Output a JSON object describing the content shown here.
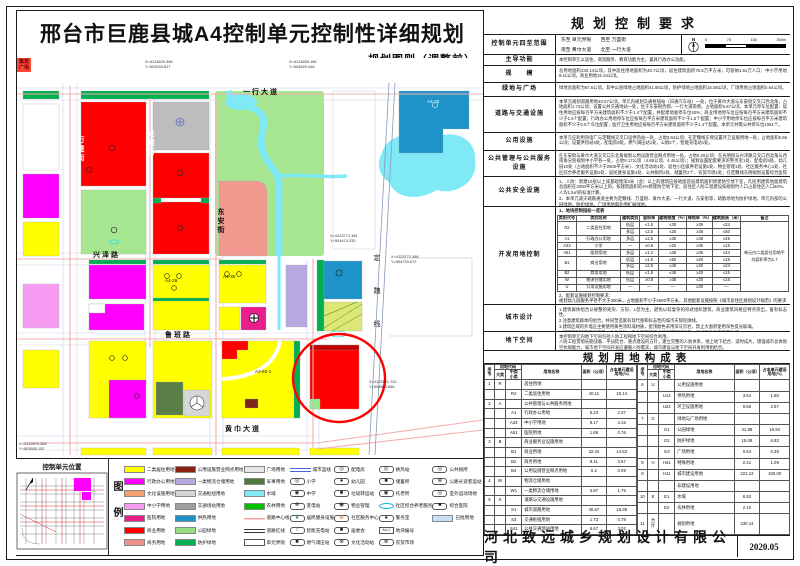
{
  "title": {
    "main": "邢台市巨鹿县城A4控制单元控制性详细规划",
    "sub": "——规划图则（调整前）"
  },
  "map": {
    "labels": [
      {
        "t": "一行大道",
        "x": 226,
        "y": 31,
        "cls": "s"
      },
      {
        "t": "兴泽路",
        "x": 76,
        "y": 194,
        "cls": "s"
      },
      {
        "t": "鲁班路",
        "x": 148,
        "y": 274,
        "cls": "s"
      },
      {
        "t": "黄巾大道",
        "x": 208,
        "y": 368,
        "cls": "s"
      },
      {
        "t": "万盛街",
        "x": 60,
        "y": 78,
        "cls": "v w"
      },
      {
        "t": "光明街",
        "x": 130,
        "y": 72,
        "cls": "v w"
      },
      {
        "t": "东安街",
        "x": 200,
        "y": 150,
        "cls": "v"
      },
      {
        "t": "定魏线",
        "x": 356,
        "y": 196,
        "cls": "v sp"
      },
      {
        "t": "A4-70",
        "x": 410,
        "y": 42,
        "cls": "b w"
      },
      {
        "t": "A4-26",
        "x": 148,
        "y": 221,
        "cls": "b"
      },
      {
        "t": "A4-30",
        "x": 206,
        "y": 217,
        "cls": "b"
      },
      {
        "t": "A4-62-1",
        "x": 238,
        "y": 312,
        "cls": "b"
      }
    ],
    "coords": [
      {
        "l1": "X=4124629.306",
        "l2": "Y=503253.817",
        "x": 128,
        "y": 2
      },
      {
        "l1": "X=4124655.185",
        "l2": "Y=504629.448",
        "x": 272,
        "y": 2
      },
      {
        "l1": "X=4123771.381",
        "l2": "Y=504474.333",
        "x": 313,
        "y": 176
      },
      {
        "l1": "X=4123771.388",
        "l2": "Y=504733.672",
        "x": 374,
        "y": 197
      },
      {
        "l1": "X=4122991.722",
        "l2": "Y=504603.668",
        "x": 352,
        "y": 322
      },
      {
        "l1": "X=4122876.355",
        "l2": "Y=503555.152",
        "x": 2,
        "y": 384
      }
    ],
    "plaza": {
      "l1": "集贸",
      "l2": "广场",
      "x": 86,
      "y": 284
    }
  },
  "unit_location": {
    "title": "控制单元位置"
  },
  "legend": {
    "label": "图例",
    "columns": [
      [
        {
          "label": "二类居住用地",
          "sw": "c",
          "c": "#FFFF00"
        },
        {
          "label": "行政办公用地",
          "sw": "c",
          "c": "#FF00FF"
        },
        {
          "label": "文化设施用地",
          "sw": "c",
          "c": "#F4A070"
        },
        {
          "label": "中小学用地",
          "sw": "c",
          "c": "#F79CF2"
        },
        {
          "label": "医院用地",
          "sw": "c",
          "c": "#E91E8C"
        },
        {
          "label": "商业用地",
          "sw": "c",
          "c": "#FF0000"
        },
        {
          "label": "商务用地",
          "sw": "c",
          "c": "#F0908A"
        }
      ],
      [
        {
          "label": "公用设施营业网点用地",
          "sw": "c",
          "c": "#8B2015"
        },
        {
          "label": "一类物流仓储用地",
          "sw": "c",
          "c": "#B8A8E0"
        },
        {
          "label": "交通枢纽用地",
          "sw": "c",
          "c": "#D6D6D6"
        },
        {
          "label": "交通场站用地",
          "sw": "c",
          "c": "#9E9E9E"
        },
        {
          "label": "供热用地",
          "sw": "c",
          "c": "#1E93C8"
        },
        {
          "label": "公园绿地",
          "sw": "c",
          "c": "#97E081"
        },
        {
          "label": "防护绿地",
          "sw": "c",
          "c": "#00B050"
        }
      ],
      [
        {
          "label": "广场用地",
          "sw": "c",
          "c": "#E8E8E8"
        },
        {
          "label": "军事用地",
          "sw": "c",
          "c": "#4C7A3D"
        },
        {
          "label": "水域",
          "sw": "c",
          "c": "#7FE9F5"
        },
        {
          "label": "农林用地",
          "sw": "c",
          "c": "#00C000"
        },
        {
          "label": "道路中心线",
          "sw": "ln"
        },
        {
          "label": "道路红线",
          "sw": "ld"
        },
        {
          "label": "单元界限",
          "sw": "box"
        }
      ],
      [
        {
          "label": "城市蓝线",
          "sw": "lb"
        },
        {
          "label": "小学",
          "sw": "i",
          "g": "◎"
        },
        {
          "label": "中学",
          "sw": "i",
          "g": "◉"
        },
        {
          "label": "变电站",
          "sw": "i",
          "g": "⊗"
        },
        {
          "label": "居民健身设施",
          "sw": "i",
          "g": "●",
          "gc": "#2e9e3e"
        },
        {
          "label": "智能充电站",
          "sw": "i",
          "g": "○",
          "gc": "#3355cc"
        },
        {
          "label": "燃气调压站",
          "sw": "i",
          "g": "■"
        }
      ],
      [
        {
          "label": "配电房",
          "sw": "i",
          "g": "◎"
        },
        {
          "label": "幼儿园",
          "sw": "i",
          "g": "●"
        },
        {
          "label": "垃圾转运站",
          "sw": "i",
          "g": "■"
        },
        {
          "label": "物业管理",
          "sw": "i",
          "g": "◉"
        },
        {
          "label": "社区服务中心",
          "sw": "i",
          "g": "⊕",
          "gc": "#e07820"
        },
        {
          "label": "居委会",
          "sw": "i",
          "g": "■"
        },
        {
          "label": "文化活动站",
          "sw": "i",
          "g": "⊗"
        }
      ],
      [
        {
          "label": "换热站",
          "sw": "i",
          "g": "◎"
        },
        {
          "label": "储蓄所",
          "sw": "i",
          "g": "■"
        },
        {
          "label": "托老所",
          "sw": "i",
          "g": "◉"
        },
        {
          "label": "社区综合养老服务",
          "sw": "ov"
        },
        {
          "label": "警务室",
          "sw": "i",
          "g": "●"
        },
        {
          "label": "地块编号",
          "sw": "code",
          "g": "A4-1"
        },
        {
          "label": "农贸市场",
          "sw": "i",
          "g": "⊗"
        }
      ],
      [
        {
          "label": "公共厕所",
          "sw": "i",
          "g": "◎"
        },
        {
          "label": "公路长途客运站",
          "sw": "i",
          "g": "⊗"
        },
        {
          "label": "室外运动场地",
          "sw": "i",
          "g": "◎"
        },
        {
          "label": "综合医院",
          "sw": "i",
          "g": "■"
        },
        {
          "label": "已批用地",
          "sw": "c",
          "c": "#C9DFF5"
        }
      ]
    ]
  },
  "panel": {
    "title": "规划控制要求",
    "extent": {
      "label": "控制单元四至范围",
      "line1": "东至 单元界限　　西至 万盛街",
      "line2": "南至 黄巾大道　　北至 一行大道"
    },
    "compass": "N",
    "scalebar": {
      "t0": "0",
      "t1": "75",
      "t2": "150",
      "t3": "300m"
    },
    "rows": [
      {
        "label": "主导功能",
        "h": 11,
        "text": "本控制单元以居住、商贸服务、教育功能为主，兼具行政办公功能。"
      },
      {
        "label": "规　　模",
        "h": 17,
        "text": "总用地面积230.14公顷，其中居住用地面积为40.7公顷，居住建筑面积76.5万平方米，可容纳1.51万人口；中小学用地9.11公顷，商业用地32.34公顷。"
      },
      {
        "label": "绿地与广场",
        "h": 14,
        "text": "绿地总面积为67.6公顷，其中公园绿地占地面积41.88公顷，防护绿地占地面积15.08公顷，广场用地占地面积0.64公顷。"
      },
      {
        "label": "道路与交通设施",
        "h": 36,
        "text": "本单元规划道路用地40.67公顷。单元内规划交通枢纽站（日通汽车站）一处，位于黄巾大道与东安街交叉口西北角，占地面积1.73公顷；设置公共交通场站一处，位于东安街西侧、一行大道南侧，占地面积6.67公顷。本单元停车位配置：居住用地应按每百平方米建筑面积不少于1.4个配置，并配建地面停车位40%；商业用地停车位应按每百平方米建筑面积不少于1.5个配置；行政办公用地停车位应按每百平方米建筑面积不少于1.5个配置；中小学用地停车位应按每百平方米建筑面积不少于0.5个车位配置；医疗卫生用地应按每百平方米建筑面积不少于1.4个配置。本单元共需公共停车位1051个。"
      },
      {
        "label": "公用设施",
        "h": 18,
        "text": "本单元应利用热电厂与定魏线交叉口设供热站一处，占地3.94公顷；在定魏线东侧设置环卫设施用地一处，占地面积6.56公顷；设置供热站4处，配电房9处，燃气调压站1处，公厕2个，智能充电站1处。"
      },
      {
        "label": "公共管理与公共服务设施",
        "h": 26,
        "text": "在东安街与黄巾大道交叉口东北角规划公用设施营业网点用地一处，占地0.20公顷；在光明街与兴泽路交叉口西北角与西南角分别规划中小学各一处，占地9.17公顷（4.89公顷、4.46公顷）；规划设置配套要求的警务室1处、配电房9处、幼儿园10处（占地面积不少于2600平方米）、文化活动站1处、居住小区级养老设施1处、物业管理1处、社区服务中心1处、社区综合养老服务设施2处、居民健身设施4处、公共厕所2处、储蓄所2个、农贸市场1处；在定魏线东侧规划设置综合医院1个，占地面积2.35公顷。"
      },
      {
        "label": "公共安全设施",
        "h": 30,
        "text": "1、人防：新建10层以上或基础埋深3米（含）以上的建筑应按地面首层建筑面积修建防空地下室，凡民用建筑地面建筑总面积在2000平方米以上的，按建筑面积的2%修建防空地下室；居住区人防工程建设按规划时人口占居住区人口60%、人均1.5㎡的标准计算。\n2、本单元减灾疏散通道主要为定魏线、万盛街、黄巾大道、一行大道、东安街等，疏散场地为防护绿地、单元内部的公园绿地、防护绿地、广场用地和外围扩展绿地。"
      }
    ],
    "dev": {
      "label": "开发用地控制",
      "note1": "1、地块控制指标一览表",
      "table": {
        "head": [
          [
            "类别代号",
            "类别名称",
            "建筑类别",
            "容积率",
            "建筑密度（%）",
            "绿地率（%）",
            "建筑限高（米）",
            "备注"
          ]
        ],
        "body": [
          [
            {
              "t": "R2",
              "rs": 2
            },
            {
              "t": "二类居住用地",
              "rs": 2
            },
            "低层",
            "≤1.5",
            "≤30",
            "≥35",
            "≤24",
            {
              "t": "单元内二类居住用地平均容积率为1.7",
              "rs": 10,
              "cls": "beizhu"
            }
          ],
          [
            "多层",
            "≤2.5",
            "≤25",
            "≥35",
            "≤60"
          ],
          [
            "A1",
            "行政办公用地",
            "多层",
            "≤2.5",
            "≤35",
            "≥35",
            "≤45"
          ],
          [
            "A33",
            "小学",
            "—",
            "≤0.8",
            "≤25",
            "≥35",
            "≤15"
          ],
          [
            "A51",
            "医院用地",
            "多层",
            "≤1.2",
            "≤35",
            "≥35",
            "≤24"
          ],
          [
            {
              "t": "B1",
              "rs": 2
            },
            {
              "t": "商业用地",
              "rs": 2
            },
            "低层",
            "≤1.5",
            "≤50",
            "≥20",
            "≤15"
          ],
          [
            "多层",
            "≤2.5",
            "≤45",
            "≥20",
            "≤24"
          ],
          [
            "B2",
            "商务用地",
            "低层",
            "≤1.5",
            "≤45",
            "≥20",
            "≤15"
          ],
          [
            "W",
            "物流仓储用地",
            "低层",
            "≥0.8",
            "≥35",
            "≤20",
            "≤16"
          ],
          [
            "U",
            "公用设施用地",
            "—",
            "—",
            "—",
            "≥30",
            "—"
          ]
        ]
      },
      "note2": "2、配套设施规划控制要求：\n规划幼儿园服务半径不大于300米，占地面积不小于2600平方米，其他配套设施按照《城市居住区规划设计规范》的要求配置。"
    },
    "urban": {
      "label": "城市设计",
      "text": "1.建筑群体组合以规整的矩形、方形、L型为主，避免以较复杂的形式组织建筑，商业建筑风格应特点突出，富有标志性。\n2.注意建筑群体的组合，共同塑造富有现代感和标志性的城市天际轮廓线。\n3.建筑区域的外墙应主要使用黄色涂料或材质，屋顶颜色采用深灰页岩，禁止大面积使用深色反光玻璃。\n4.建筑照明设施要与建筑一体化设计，商业建筑顶部必须有照明灯设施，且光源色彩应表现协调。"
    },
    "under": {
      "label": "地下空间",
      "text": "本控制单元内地下空间包括人防工程和地下空间综合利用。\n人防工程贯彻长期战备、平战结合、重点建设的方针，建立完整的人防体系，地上地下结合、适时成片，增强城市总体防空抗毁能力，城市地下空间开发应遵循人防需求，城市建设与地下空间开发利用相结合。"
    }
  },
  "land_table": {
    "title": "规划用地构成表",
    "left": {
      "head": [
        [
          {
            "t": "序号",
            "rs": 2
          },
          {
            "t": "用地代码",
            "cs": 2
          },
          {
            "t": "用地名称",
            "rs": 2
          },
          {
            "t": "面积（公顷）",
            "rs": 2
          },
          {
            "t": "占本单元建设用地(%)",
            "rs": 2
          }
        ],
        [
          "大类",
          "中类 小类"
        ]
      ],
      "body": [
        [
          "1",
          "R",
          "",
          {
            "t": "居住用地",
            "cls": "nm"
          },
          "",
          ""
        ],
        [
          "",
          "",
          "R2",
          {
            "t": "二类居住用地",
            "cls": "nm"
          },
          "40.11",
          "18.14"
        ],
        [
          "2",
          "A",
          "",
          {
            "t": "公共管理与公共服务用地",
            "cls": "nm"
          },
          "",
          ""
        ],
        [
          "",
          "",
          "A1",
          {
            "t": "行政办公用地",
            "cls": "nm"
          },
          "5.23",
          "2.37"
        ],
        [
          "",
          "",
          "A33",
          {
            "t": "中小学用地",
            "cls": "nm"
          },
          "9.17",
          "4.15"
        ],
        [
          "",
          "",
          "A51",
          {
            "t": "医院用地",
            "cls": "nm"
          },
          "1.69",
          "0.76"
        ],
        [
          "3",
          "B",
          "",
          {
            "t": "商业服务业设施用地",
            "cls": "nm"
          },
          "",
          ""
        ],
        [
          "",
          "",
          "B1",
          {
            "t": "商业用地",
            "cls": "nm"
          },
          "32.34",
          "14.63"
        ],
        [
          "",
          "",
          "B2",
          {
            "t": "商务用地",
            "cls": "nm"
          },
          "8.11",
          "3.67"
        ],
        [
          "",
          "",
          "B4",
          {
            "t": "公用设施营业网点用地",
            "cls": "nm"
          },
          "0.2",
          "0.09"
        ],
        [
          "4",
          "W",
          "",
          {
            "t": "物流仓储用地",
            "cls": "nm"
          },
          "",
          ""
        ],
        [
          "",
          "",
          "W1",
          {
            "t": "一类物流仓储用地",
            "cls": "nm"
          },
          "3.87",
          "1.75"
        ],
        [
          "5",
          "S",
          "",
          {
            "t": "道路与交通设施用地",
            "cls": "nm"
          },
          "",
          ""
        ],
        [
          "",
          "",
          "S1",
          {
            "t": "城市道路用地",
            "cls": "nm"
          },
          "40.67",
          "18.39"
        ],
        [
          "",
          "",
          "S3",
          {
            "t": "交通枢纽用地",
            "cls": "nm"
          },
          "1.73",
          "0.78"
        ],
        [
          "",
          "",
          "S41",
          {
            "t": "公共交通场站用地",
            "cls": "nm"
          },
          "6.67",
          "3.02"
        ]
      ]
    },
    "right": {
      "head": [
        [
          {
            "t": "序号",
            "rs": 2
          },
          {
            "t": "用地代码",
            "cs": 2
          },
          {
            "t": "用地名称",
            "rs": 2
          },
          {
            "t": "面积（公顷）",
            "rs": 2
          },
          {
            "t": "占本单元建设用地(%)",
            "rs": 2
          }
        ],
        [
          "大类",
          "中类 小类"
        ]
      ],
      "body": [
        [
          "6",
          "U",
          "",
          {
            "t": "公用设施用地",
            "cls": "nm"
          },
          "",
          ""
        ],
        [
          "",
          "",
          "U14",
          {
            "t": "供热用地",
            "cls": "nm"
          },
          "3.54",
          "1.60"
        ],
        [
          "",
          "",
          "U22",
          {
            "t": "环卫设施用地",
            "cls": "nm"
          },
          "6.56",
          "2.97"
        ],
        [
          "7",
          "G",
          "",
          {
            "t": "绿地与广场用地",
            "cls": "nm"
          },
          "",
          ""
        ],
        [
          "",
          "",
          "G1",
          {
            "t": "公园绿地",
            "cls": "nm"
          },
          "41.88",
          "18.94"
        ],
        [
          "",
          "",
          "G2",
          {
            "t": "防护绿地",
            "cls": "nm"
          },
          "15.08",
          "6.82"
        ],
        [
          "",
          "",
          "G3",
          {
            "t": "广场用地",
            "cls": "nm"
          },
          "0.64",
          "0.29"
        ],
        [
          "8",
          "H",
          "H41",
          {
            "t": "特殊用地",
            "cls": "nm"
          },
          "2.41",
          "1.09"
        ],
        [
          "9",
          "",
          "H11",
          {
            "t": "城市建设用地",
            "cls": "nm"
          },
          "221.12",
          "100.00"
        ],
        [
          "",
          "",
          "",
          {
            "t": "非建设用地",
            "cls": "nm"
          },
          "",
          ""
        ],
        [
          "10",
          "E",
          "E1",
          {
            "t": "水域",
            "cls": "nm"
          },
          "6.92",
          ""
        ],
        [
          "",
          "",
          "E2",
          {
            "t": "农林用地",
            "cls": "nm"
          },
          "2.10",
          ""
        ],
        [
          "11",
          "合计",
          "",
          {
            "t": "规划用地",
            "cls": "nm"
          },
          "230.14",
          ""
        ]
      ]
    }
  },
  "footer": {
    "company": "河北致远城乡规划设计有限公司",
    "date": "2020.05"
  }
}
